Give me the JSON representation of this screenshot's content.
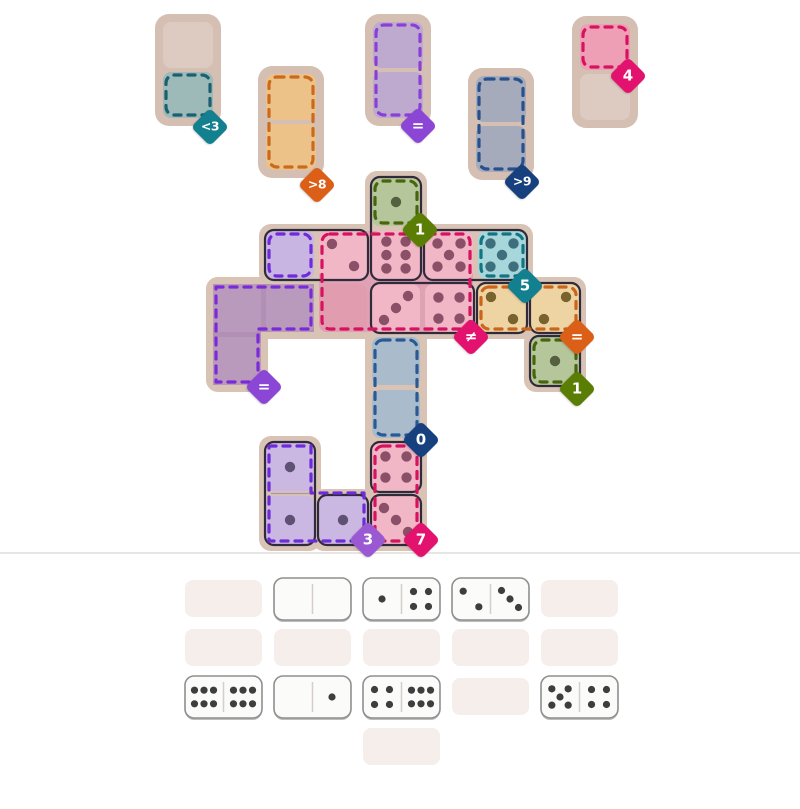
{
  "colors": {
    "board_frame": "#d8c3b5",
    "slot_frame": "#d5bfb2",
    "beige_cell": "#ddcac1",
    "domino_outline": "#2f2b3a",
    "divider_line": "#e8e6e5",
    "tray_placeholder": "#f5eeea",
    "tray_domino_bg": "#fbfbfa",
    "tray_domino_border": "#8f8f8f",
    "tray_domino_shadow": "#bdbdbd",
    "tray_pip": "#3e3e3e",
    "tray_half_divider": "#d4cfcc",
    "domino_half_divider": "#a896b8"
  },
  "badges": [
    {
      "label": "<3",
      "color": "#13808f",
      "cx": 210,
      "cy": 127
    },
    {
      "label": ">8",
      "color": "#db5f17",
      "cx": 317,
      "cy": 185
    },
    {
      "label": "=",
      "color": "#8b46d6",
      "cx": 418,
      "cy": 126
    },
    {
      "label": ">9",
      "color": "#16407e",
      "cx": 522,
      "cy": 182
    },
    {
      "label": "4",
      "color": "#e3126e",
      "cx": 628,
      "cy": 76
    },
    {
      "label": "1",
      "color": "#5a7d04",
      "cx": 420,
      "cy": 230
    },
    {
      "label": "5",
      "color": "#13808f",
      "cx": 525,
      "cy": 286
    },
    {
      "label": "≠",
      "color": "#e3126e",
      "cx": 471,
      "cy": 337
    },
    {
      "label": "=",
      "color": "#db5f17",
      "cx": 577,
      "cy": 337
    },
    {
      "label": "1",
      "color": "#5a7d04",
      "cx": 577,
      "cy": 389
    },
    {
      "label": "0",
      "color": "#16407e",
      "cx": 421,
      "cy": 440
    },
    {
      "label": "=",
      "color": "#8b46d6",
      "cx": 264,
      "cy": 387
    },
    {
      "label": "3",
      "color": "#9a59d3",
      "cx": 368,
      "cy": 540
    },
    {
      "label": "7",
      "color": "#e3126e",
      "cx": 421,
      "cy": 540
    }
  ],
  "top_slots": [
    {
      "id": "less-than-3",
      "x": 155,
      "y": 14,
      "dash_span": "bottom",
      "dash": "#1b606f",
      "cells": [
        {
          "fill": "#ddcac1"
        },
        {
          "fill": "#9db9b8"
        }
      ]
    },
    {
      "id": "greater-than-8",
      "x": 258,
      "y": 66,
      "dash_span": "both",
      "dash": "#c96a1c",
      "cells": [
        {
          "fill": "#ecc289"
        },
        {
          "fill": "#ecc289"
        }
      ]
    },
    {
      "id": "equal",
      "x": 365,
      "y": 14,
      "dash_span": "both",
      "dash": "#8a3fd6",
      "cells": [
        {
          "fill": "#bfaacf"
        },
        {
          "fill": "#bfaacf"
        }
      ]
    },
    {
      "id": "greater-than-9",
      "x": 468,
      "y": 68,
      "dash_span": "both",
      "dash": "#27508d",
      "cells": [
        {
          "fill": "#a5abbb"
        },
        {
          "fill": "#a5abbb"
        }
      ]
    },
    {
      "id": "sum-4",
      "x": 572,
      "y": 16,
      "dash_span": "top",
      "dash": "#d6135e",
      "cells": [
        {
          "fill": "#ef9fb5"
        },
        {
          "fill": "#ddcac1"
        }
      ]
    }
  ],
  "board": {
    "grid": {
      "origin_x": 213,
      "origin_y": 178,
      "pitch": 53,
      "cell_size": 48
    },
    "frame_blocks": [
      [
        365,
        171,
        62,
        380
      ],
      [
        259,
        224,
        274,
        62
      ],
      [
        206,
        277,
        380,
        62
      ],
      [
        206,
        277,
        62,
        115
      ],
      [
        524,
        330,
        62,
        62
      ],
      [
        259,
        436,
        62,
        115
      ],
      [
        312,
        489,
        62,
        62
      ]
    ],
    "washes": [
      {
        "rect": [
          319,
          231,
          154,
          101
        ],
        "fill": "#dfa2b4"
      },
      {
        "path": "M213,284 H314 V332 H261 V385 H213 Z",
        "fill": "#b28fb4"
      }
    ],
    "cells": [
      {
        "id": "A2",
        "col": 0,
        "row": 2,
        "fill": "#ba9abc",
        "pips": 0
      },
      {
        "id": "A3",
        "col": 0,
        "row": 3,
        "fill": "#ba9abc",
        "pips": 0
      },
      {
        "id": "B2",
        "col": 1,
        "row": 2,
        "fill": "#ba9abc",
        "pips": 0
      },
      {
        "id": "B1",
        "col": 1,
        "row": 1,
        "fill": "#c8b5e1",
        "pips": 0
      },
      {
        "id": "C1",
        "col": 2,
        "row": 1,
        "fill": "#f2b7c6",
        "pips": 2,
        "pat": "2",
        "pip_color": "#8a5068"
      },
      {
        "id": "C2",
        "col": 2,
        "row": 2,
        "fill": "#e29cb0",
        "pips": 0
      },
      {
        "id": "D0",
        "col": 3,
        "row": 0,
        "fill": "#b6c69b",
        "pips": 1,
        "pat": "1",
        "pip_color": "#54603f"
      },
      {
        "id": "D1",
        "col": 3,
        "row": 1,
        "fill": "#f2b7c6",
        "pips": 6,
        "pat": "6v",
        "pip_color": "#8a5068"
      },
      {
        "id": "D2",
        "col": 3,
        "row": 2,
        "fill": "#f2b7c6",
        "pips": 3,
        "pat": "3r",
        "pip_color": "#8a5068"
      },
      {
        "id": "D3",
        "col": 3,
        "row": 3,
        "fill": "#aabbcb",
        "pips": 0
      },
      {
        "id": "D4",
        "col": 3,
        "row": 4,
        "fill": "#aabbcb",
        "pips": 0
      },
      {
        "id": "D5",
        "col": 3,
        "row": 5,
        "fill": "#f2b7c6",
        "pips": 4,
        "pat": "4",
        "pip_color": "#8a5068"
      },
      {
        "id": "D6",
        "col": 3,
        "row": 6,
        "fill": "#f2b7c6",
        "pips": 3,
        "pat": "3",
        "pip_color": "#8a5068"
      },
      {
        "id": "E1",
        "col": 4,
        "row": 1,
        "fill": "#f2b7c6",
        "pips": 5,
        "pat": "5",
        "pip_color": "#8a5068"
      },
      {
        "id": "E2",
        "col": 4,
        "row": 2,
        "fill": "#f2b7c6",
        "pips": 4,
        "pat": "4",
        "pip_color": "#8a5068"
      },
      {
        "id": "F1",
        "col": 5,
        "row": 1,
        "fill": "#a7d7db",
        "pips": 5,
        "pat": "5",
        "pip_color": "#3d6f7d"
      },
      {
        "id": "F2",
        "col": 5,
        "row": 2,
        "fill": "#efd4a3",
        "pips": 2,
        "pat": "2",
        "pip_color": "#78632c"
      },
      {
        "id": "G2",
        "col": 6,
        "row": 2,
        "fill": "#efd4a3",
        "pips": 2,
        "pat": "2a",
        "pip_color": "#78632c"
      },
      {
        "id": "G3",
        "col": 6,
        "row": 3,
        "fill": "#b6c69b",
        "pips": 1,
        "pat": "1",
        "pip_color": "#54603f"
      },
      {
        "id": "B5",
        "col": 1,
        "row": 5,
        "fill": "#cab8e3",
        "pips": 1,
        "pat": "1",
        "pip_color": "#5e5174"
      },
      {
        "id": "B6",
        "col": 1,
        "row": 6,
        "fill": "#cab8e3",
        "pips": 1,
        "pat": "1",
        "pip_color": "#5e5174"
      },
      {
        "id": "C6",
        "col": 2,
        "row": 6,
        "fill": "#cab8e3",
        "pips": 1,
        "pat": "1",
        "pip_color": "#5e5174"
      }
    ],
    "outlines": [
      {
        "cells": [
          "B1",
          "C1"
        ]
      },
      {
        "cells": [
          "D0",
          "D1"
        ]
      },
      {
        "cells": [
          "E1",
          "F1"
        ]
      },
      {
        "cells": [
          "D2",
          "E2"
        ]
      },
      {
        "cells": [
          "B5",
          "B6"
        ],
        "divider": true
      },
      {
        "cells": [
          "F2"
        ]
      },
      {
        "cells": [
          "G2"
        ]
      },
      {
        "cells": [
          "G3"
        ]
      },
      {
        "cells": [
          "D5"
        ]
      },
      {
        "cells": [
          "D6"
        ]
      },
      {
        "cells": [
          "C6"
        ]
      }
    ],
    "zone_dashes": [
      {
        "rect": [
          375,
          181,
          42,
          42
        ],
        "color": "#48650e"
      },
      {
        "rect": [
          322,
          234,
          148,
          95
        ],
        "color": "#d6135e"
      },
      {
        "rect": [
          481,
          234,
          42,
          42
        ],
        "color": "#147482"
      },
      {
        "rect": [
          481,
          287,
          95,
          42
        ],
        "color": "#ca651b"
      },
      {
        "rect": [
          534,
          340,
          42,
          42
        ],
        "color": "#48650e"
      },
      {
        "rect": [
          375,
          340,
          42,
          95
        ],
        "color": "#2a5a94"
      },
      {
        "rect": [
          375,
          446,
          42,
          95
        ],
        "color": "#d6135e"
      },
      {
        "rect": [
          269,
          234,
          42,
          42
        ],
        "color": "#6f2bd9"
      },
      {
        "path": "M216,287 H311 V329 H258 V382 H216 Z",
        "color": "#7a2ad6"
      },
      {
        "path": "M269,446 H311 V493 H364 V541 H269 Z",
        "color": "#6f2bd9"
      }
    ]
  },
  "tray": {
    "divider_y": 553,
    "rows": [
      [
        {
          "t": "empty"
        },
        {
          "t": "dom",
          "l": 0,
          "r": 0
        },
        {
          "t": "dom",
          "l": 1,
          "r": 4
        },
        {
          "t": "dom",
          "l": 2,
          "r": 3
        },
        {
          "t": "empty"
        }
      ],
      [
        {
          "t": "empty"
        },
        {
          "t": "empty"
        },
        {
          "t": "empty"
        },
        {
          "t": "empty"
        },
        {
          "t": "empty"
        }
      ],
      [
        {
          "t": "dom",
          "l": 6,
          "r": 6
        },
        {
          "t": "dom",
          "l": 0,
          "r": 1
        },
        {
          "t": "dom",
          "l": 4,
          "r": 6
        },
        {
          "t": "empty"
        },
        {
          "t": "dom",
          "l": 5,
          "r": 4
        }
      ],
      [
        null,
        null,
        {
          "t": "empty"
        },
        null,
        null
      ]
    ]
  }
}
